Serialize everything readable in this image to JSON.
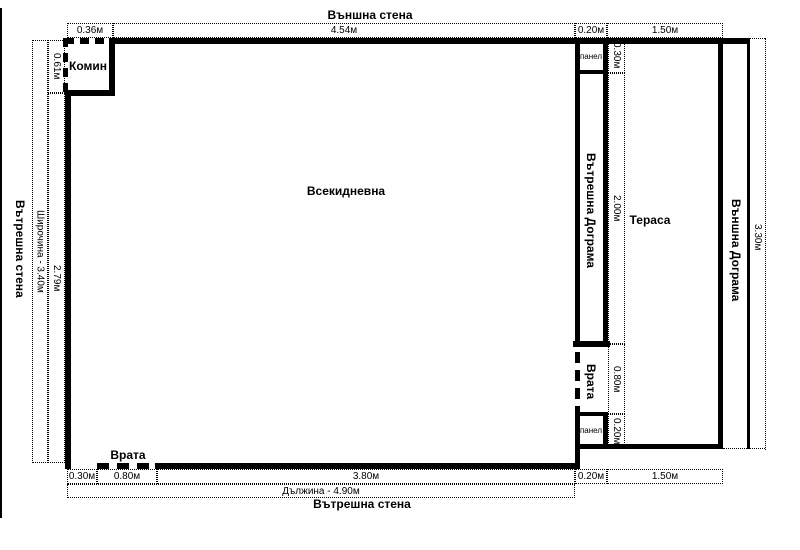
{
  "plan": {
    "titles": {
      "top": "Външна стена",
      "bottom": "Вътрешна стена",
      "left": "Вътрешна стена"
    },
    "rooms": {
      "living": "Всекидневна",
      "terrace": "Тераса",
      "chimney": "Комин"
    },
    "doors": {
      "bottom": "Врата",
      "right": "Врата"
    },
    "frames": {
      "internal": "Вътрешна Дограма",
      "external": "Външна Дограма"
    },
    "panels": {
      "top": "панел",
      "bottom": "панел"
    },
    "dims": {
      "top": [
        "0.36м",
        "4.54м",
        "0.20м",
        "1.50м"
      ],
      "bottom": [
        "0.30м",
        "0.80м",
        "3.80м",
        "0.20м",
        "1.50м"
      ],
      "bottom_total": "Дължина - 4.90м",
      "left_total": "Широчина - 3.40м",
      "left": [
        "0.61м",
        "2.79м"
      ],
      "right": [
        "0.30м",
        "2.00м",
        "0.80м",
        "0.20м"
      ],
      "right_total": "3.30м"
    },
    "colors": {
      "line": "#000000",
      "background": "#ffffff"
    }
  }
}
